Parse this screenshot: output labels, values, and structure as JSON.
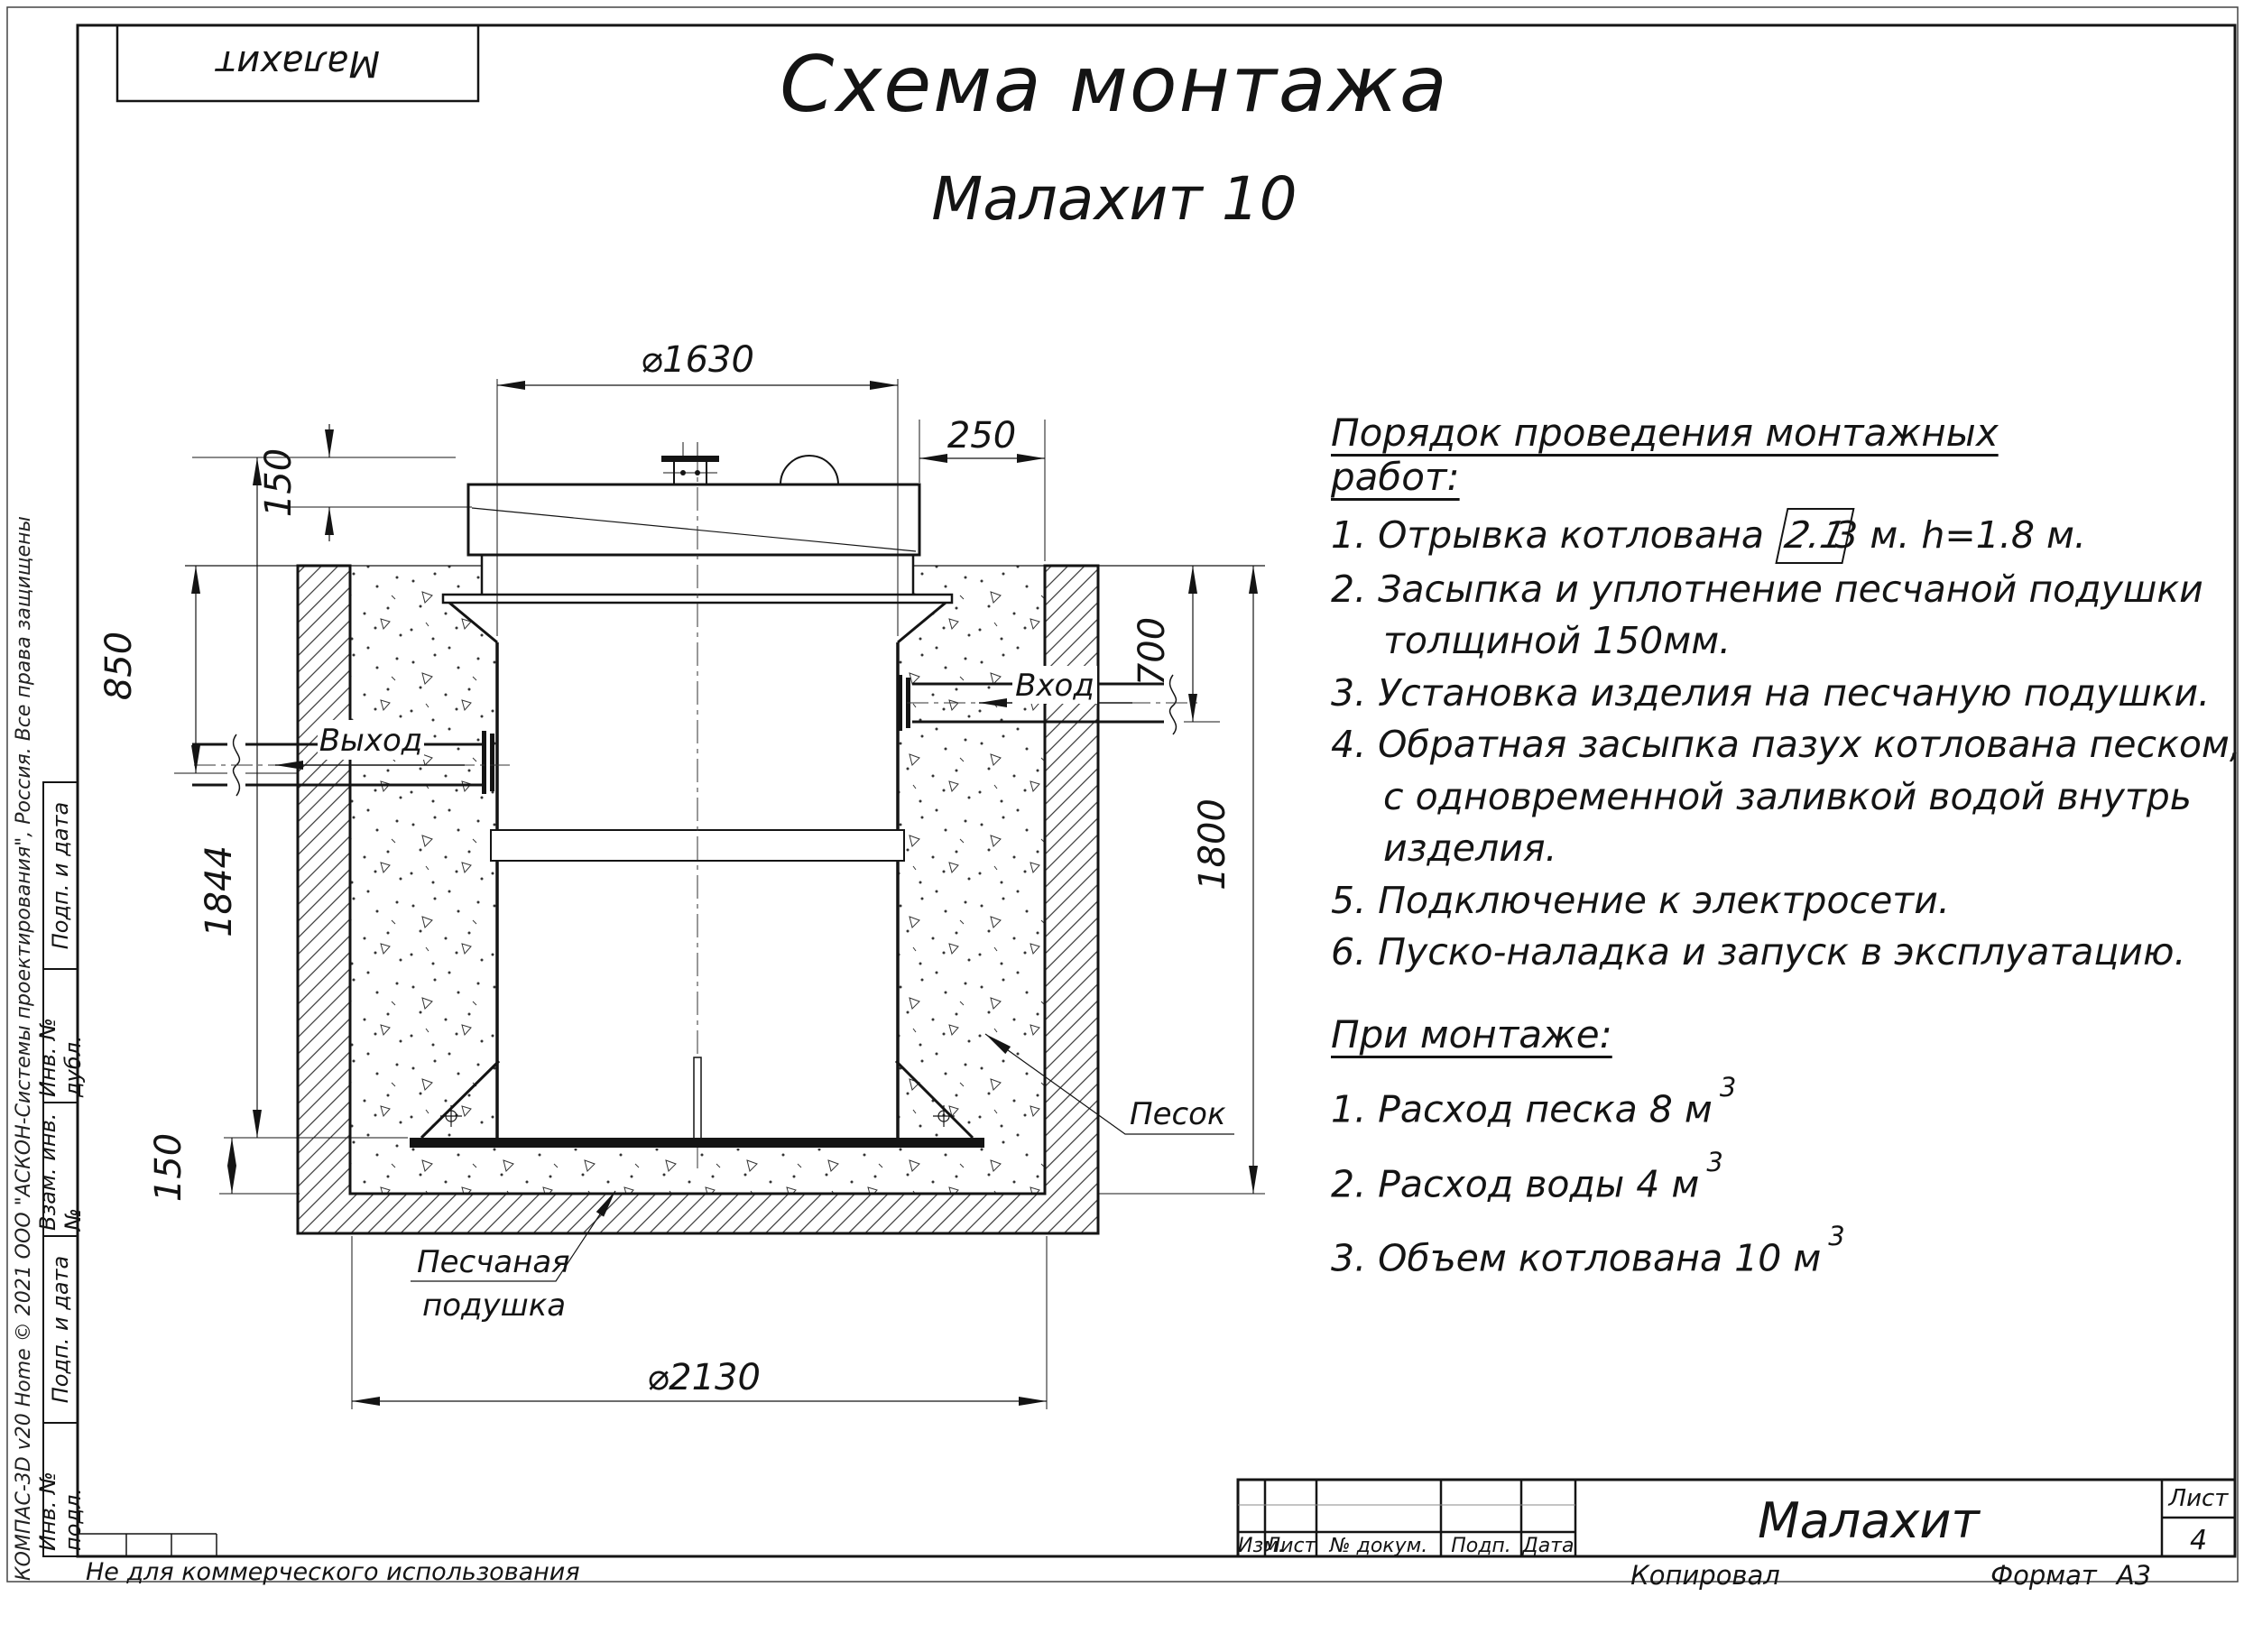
{
  "colors": {
    "ink": "#141414",
    "paper": "#ffffff"
  },
  "page": {
    "top_left_stamp": "Малахит",
    "title_line1": "Схема монтажа",
    "title_line2": "Малахит 10",
    "footer_note": "Не для коммерческого использования",
    "side_copyright": "КОМПАС-3D v20 Home © 2021 ООО \"АСКОН-Системы проектирования\", Россия. Все права защищены"
  },
  "side_stamp_boxes": {
    "box1": "Подп. и дата",
    "box2": "Инв. № дубл.",
    "box3": "Взам. инв. №",
    "box4": "Подп. и дата",
    "box5": "Инв. № подл."
  },
  "instructions": {
    "heading": "Порядок проведения монтажных работ:",
    "item1": {
      "pre": "1. Отрывка котлована ",
      "boxed": "2.1",
      "post": "3 м. h=1.8 м."
    },
    "lines": [
      "2. Засыпка и уплотнение песчаной подушки",
      "толщиной 150мм.",
      "3. Установка изделия на песчаную подушки.",
      "4. Обратная засыпка пазух котлована песком,",
      "с одновременной заливкой водой внутрь",
      "изделия.",
      "5. Подключение к электросети.",
      "6. Пуско-наладка и запуск в эксплуатацию."
    ]
  },
  "notes": {
    "heading": "При монтаже:",
    "items": [
      {
        "text": "1. Расход песка 8 м",
        "sup": "3"
      },
      {
        "text": "2. Расход воды 4 м",
        "sup": "3"
      },
      {
        "text": "3. Объем котлована 10 м",
        "sup": "3"
      }
    ]
  },
  "drawing": {
    "dims": {
      "d1630": "⌀1630",
      "top_right_250": "250",
      "top_left_150": "150",
      "left_850": "850",
      "left_1844": "1844",
      "bottom_left_150": "150",
      "right_700": "700",
      "right_1800": "1800",
      "d2130": "⌀2130"
    },
    "labels": {
      "outlet": "Выход",
      "inlet": "Вход",
      "sand": "Песок",
      "cushion_line1": "Песчаная",
      "cushion_line2": "подушка"
    }
  },
  "title_block": {
    "col_izm": "Изм.",
    "col_list": "Лист",
    "col_doc": "№ докум.",
    "col_podp": "Подп.",
    "col_data": "Дата",
    "doc_name": "Малахит",
    "sheet_label": "Лист",
    "sheet_number": "4",
    "copied_label": "Копировал",
    "format_label": "Формат",
    "format_value": "А3"
  }
}
